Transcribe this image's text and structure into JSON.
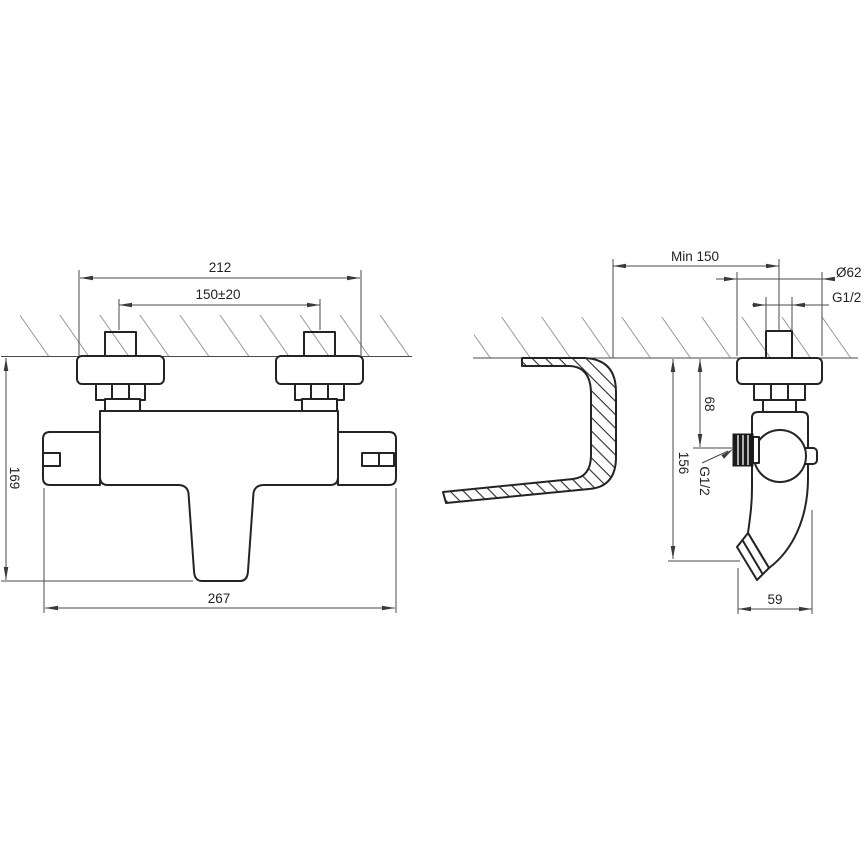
{
  "drawing_title": "Wall-mounted thermostatic bath mixer installation dimensions",
  "front_view": {
    "width_over_rosettes": "212",
    "inlet_spacing": "150±20",
    "height": "169",
    "overall_width": "267"
  },
  "side_view": {
    "min_wall_clearance": "Min 150",
    "rosette_diameter": "Ø62",
    "inlet_thread": "G1/2",
    "wall_to_shower_outlet": "68",
    "wall_to_spout_end": "156",
    "shower_outlet_thread": "G1/2",
    "spout_reach": "59"
  },
  "colors": {
    "background": "#ffffff",
    "outline": "#242424",
    "dimension_lines": "#4a4a4a",
    "wall_hatch": "#9a9a9a",
    "section_hatch": "#2e2e2e"
  }
}
